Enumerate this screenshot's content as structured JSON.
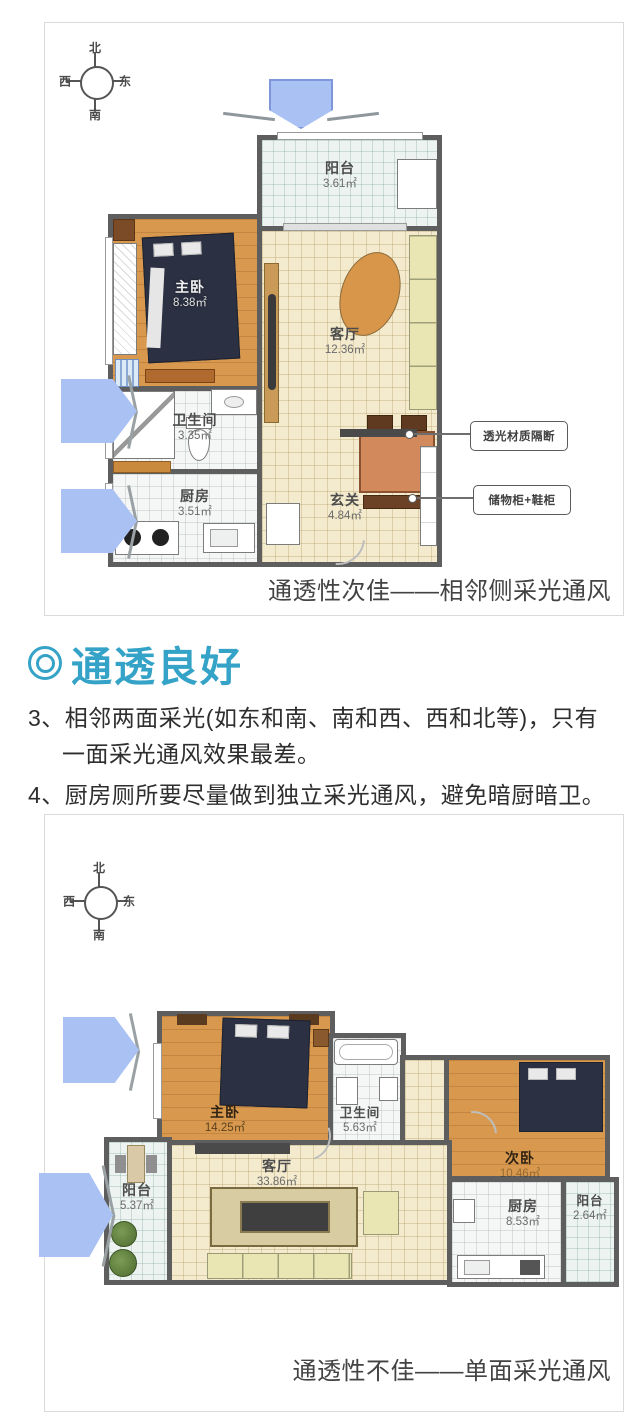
{
  "section1": {
    "compass": {
      "north": "北",
      "south": "南",
      "west": "西",
      "east": "东"
    },
    "rooms": {
      "balcony": {
        "name": "阳台",
        "area": "3.61㎡"
      },
      "master": {
        "name": "主卧",
        "area": "8.38㎡"
      },
      "living": {
        "name": "客厅",
        "area": "12.36㎡"
      },
      "bath": {
        "name": "卫生间",
        "area": "3.35㎡"
      },
      "kitchen": {
        "name": "厨房",
        "area": "3.51㎡"
      },
      "entry": {
        "name": "玄关",
        "area": "4.84㎡"
      }
    },
    "callouts": {
      "partition": "透光材质隔断",
      "cabinet": "储物柜+鞋柜"
    },
    "caption": "通透性次佳——相邻侧采光通风"
  },
  "article": {
    "heading": "通透良好",
    "points": [
      "3、相邻两面采光(如东和南、南和西、西和北等)，只有一面采光通风效果最差。",
      "4、厨房厕所要尽量做到独立采光通风，避免暗厨暗卫。"
    ]
  },
  "section2": {
    "compass": {
      "north": "北",
      "south": "南",
      "west": "西",
      "east": "东"
    },
    "rooms": {
      "master": {
        "name": "主卧",
        "area": "14.25㎡"
      },
      "bath": {
        "name": "卫生间",
        "area": "5.63㎡"
      },
      "second": {
        "name": "次卧",
        "area": "10.46㎡"
      },
      "living": {
        "name": "客厅",
        "area": "33.86㎡"
      },
      "balcony_left": {
        "name": "阳台",
        "area": "5.37㎡"
      },
      "kitchen": {
        "name": "厨房",
        "area": "8.53㎡"
      },
      "balcony_right": {
        "name": "阳台",
        "area": "2.64㎡"
      }
    },
    "caption": "通透性不佳——单面采光通风"
  },
  "colors": {
    "heading_teal": "#35a3c7",
    "arrow_blue": "#a9c2f3",
    "wall_gray": "#5e5e5e",
    "wood_floor": "#d8994e",
    "bed_navy": "#2b3042"
  }
}
